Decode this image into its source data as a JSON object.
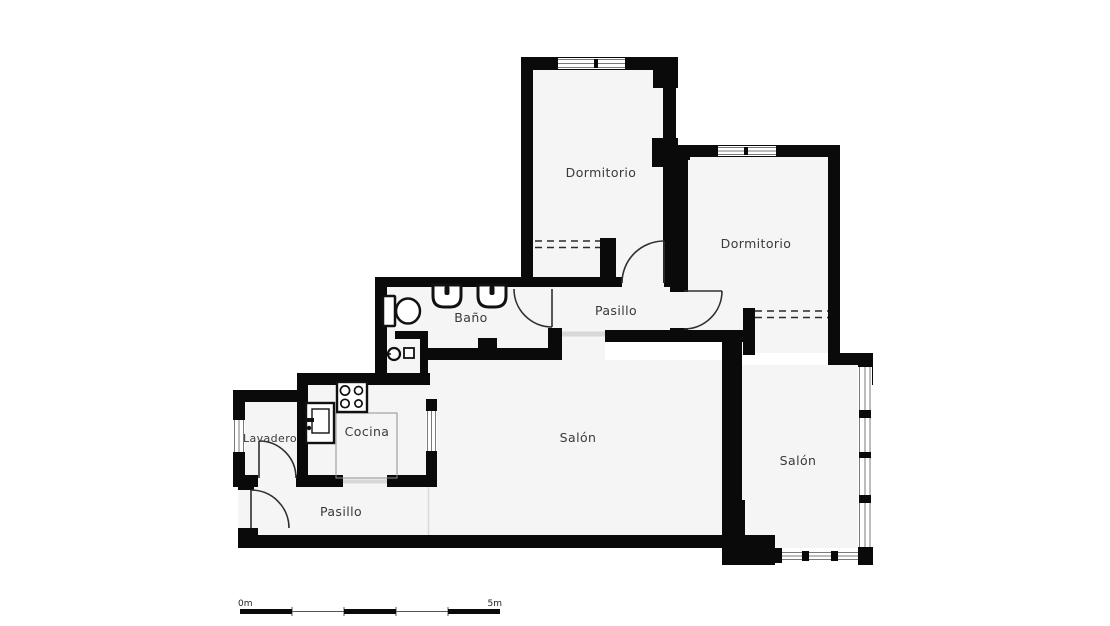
{
  "title": "Apartment floor plan",
  "rooms": [
    {
      "id": "dormitorio-1",
      "label": "Dormitorio"
    },
    {
      "id": "dormitorio-2",
      "label": "Dormitorio"
    },
    {
      "id": "pasillo-1",
      "label": "Pasillo"
    },
    {
      "id": "bano",
      "label": "Baño"
    },
    {
      "id": "cocina",
      "label": "Cocina"
    },
    {
      "id": "lavadero",
      "label": "Lavadero"
    },
    {
      "id": "pasillo-2",
      "label": "Pasillo"
    },
    {
      "id": "salon-1",
      "label": "Salón"
    },
    {
      "id": "salon-2",
      "label": "Salón"
    }
  ],
  "scale_bar": {
    "start_label": "0m",
    "end_label": "5m"
  },
  "fixtures": [
    {
      "name": "toilet-icon"
    },
    {
      "name": "washbasin-icon"
    },
    {
      "name": "washbasin-icon"
    },
    {
      "name": "stove-icon"
    },
    {
      "name": "kitchen-sink-icon"
    },
    {
      "name": "counter-outline"
    },
    {
      "name": "drain-icon"
    },
    {
      "name": "appliance-icon"
    }
  ],
  "colors": {
    "wall": "#0a0a0a",
    "floor": "#f5f5f5",
    "background": "#ffffff",
    "label_text": "#3a3a3a",
    "door_line": "#2f2f2f"
  }
}
